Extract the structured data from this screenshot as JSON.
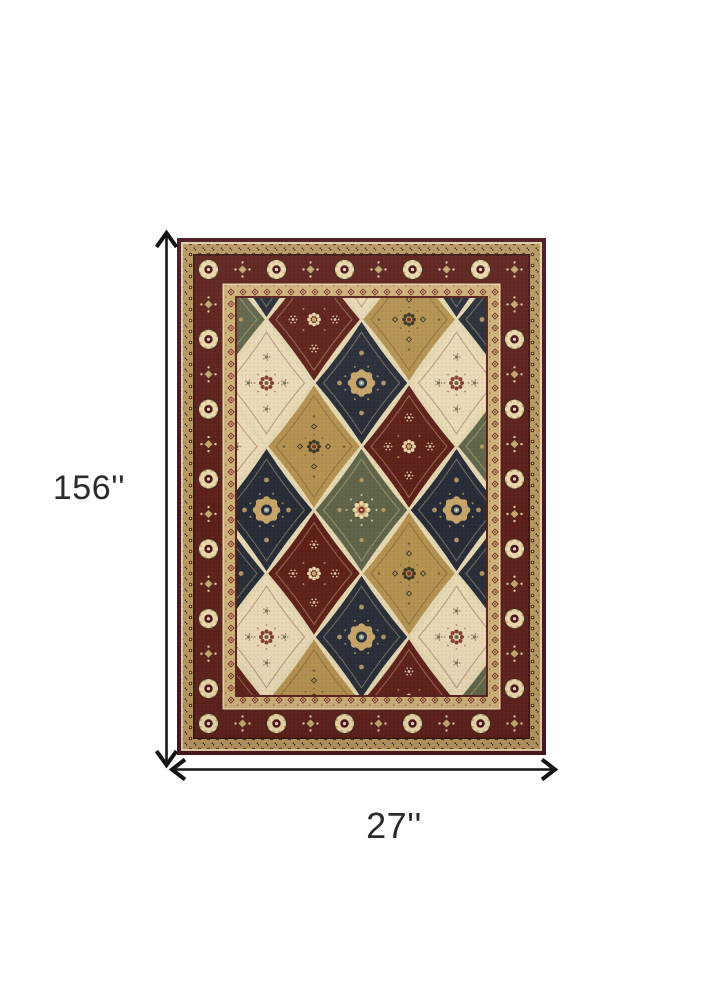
{
  "product_diagram": {
    "description": "Oriental patchwork panel area rug shown flat with size dimension arrows",
    "background": "#ffffff"
  },
  "dimensions": {
    "height_label": "156''",
    "width_label": "27''",
    "line_color": "#151515",
    "label_color": "#2b2b2b"
  },
  "rug": {
    "palette": {
      "edge": "#491420",
      "cream_line": "#e2d1a5",
      "guard_outer": "#b69760",
      "dark_line": "#301712",
      "main_border": "#5c1f1a",
      "motif_tan": "#c7a56a",
      "motif_light": "#e9d8ab",
      "motif_dark": "#2f2a20",
      "guard_inner": "#cdb17b",
      "inner_line": "#58201c",
      "field_bg": "#e3d6b0",
      "maroon": "#5d1f18",
      "navy": "#262b36",
      "tan": "#b3914f",
      "cream": "#ead9b5",
      "green": "#5f6448",
      "accent_red": "#7e2d20",
      "accent_blue": "#8fa3a0"
    },
    "field": {
      "cols": [
        42,
        89.5,
        137,
        184.5,
        232,
        279.5,
        327
      ],
      "rows_a": [
        18,
        145,
        272,
        399
      ],
      "rows_b": [
        81.5,
        208.5,
        335.5,
        462.5
      ],
      "diamond": {
        "w": 95,
        "h": 127
      },
      "panel_grid": [
        [
          "green",
          "cream",
          "navy",
          "maroon"
        ],
        [
          "navy",
          "cream",
          "navy",
          "cream"
        ],
        [
          "maroon",
          "tan",
          "maroon",
          "tan"
        ],
        [
          "cream",
          "navy",
          "green",
          "navy"
        ],
        [
          "tan",
          "maroon",
          "tan",
          "maroon"
        ],
        [
          "navy",
          "cream",
          "navy",
          "cream"
        ],
        [
          "navy",
          "green",
          "navy",
          "green"
        ]
      ]
    }
  }
}
